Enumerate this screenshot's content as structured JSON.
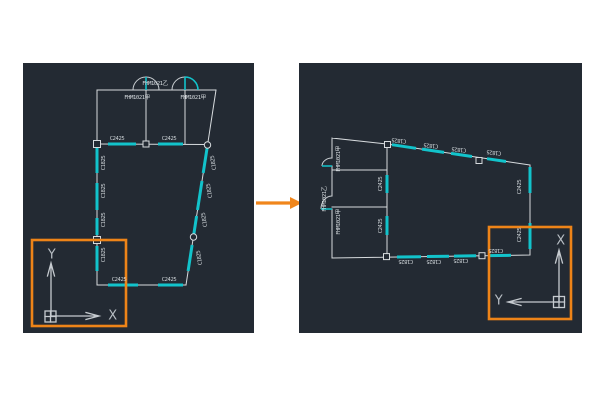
{
  "colors": {
    "viewport_background": "#232A33",
    "wall_line": "#D7DBDE",
    "window_cyan": "#12C3CB",
    "highlight_orange": "#EE8418",
    "arrow_orange": "#F0861C",
    "label_text": "#CDD3D7",
    "ucs_text": "#B7BDC3"
  },
  "panels": [
    {
      "id": "labels-left",
      "name": "viewport-before",
      "labels": [
        {
          "text": "FHM1021乙",
          "x": 132,
          "y": 20,
          "rot": 0,
          "kind": "door"
        },
        {
          "text": "FHM1021甲",
          "x": 114,
          "y": 34,
          "rot": 0,
          "kind": "door"
        },
        {
          "text": "FHM1021甲",
          "x": 170,
          "y": 34,
          "rot": 0,
          "kind": "door"
        },
        {
          "text": "C2425",
          "x": 94,
          "y": 75,
          "rot": 0,
          "kind": "window"
        },
        {
          "text": "C2425",
          "x": 146,
          "y": 75,
          "rot": 0,
          "kind": "window"
        },
        {
          "text": "C2425",
          "x": 96,
          "y": 216,
          "rot": 0,
          "kind": "window"
        },
        {
          "text": "C2425",
          "x": 146,
          "y": 216,
          "rot": 0,
          "kind": "window"
        },
        {
          "text": "C1825",
          "x": 80,
          "y": 100,
          "rot": -90,
          "kind": "window"
        },
        {
          "text": "C1825",
          "x": 80,
          "y": 128,
          "rot": -90,
          "kind": "window"
        },
        {
          "text": "C1825",
          "x": 80,
          "y": 157,
          "rot": -90,
          "kind": "window"
        },
        {
          "text": "C1825",
          "x": 80,
          "y": 192,
          "rot": -90,
          "kind": "window"
        },
        {
          "text": "C1825",
          "x": 190,
          "y": 100,
          "rot": -99,
          "kind": "window"
        },
        {
          "text": "C1825",
          "x": 186,
          "y": 128,
          "rot": -99,
          "kind": "window"
        },
        {
          "text": "C1825",
          "x": 181,
          "y": 157,
          "rot": -99,
          "kind": "window"
        },
        {
          "text": "C1825",
          "x": 176,
          "y": 195,
          "rot": -99,
          "kind": "window"
        },
        {
          "text": "Y",
          "x": 29,
          "y": 191,
          "rot": 0,
          "kind": "ucs"
        },
        {
          "text": "X",
          "x": 90,
          "y": 252,
          "rot": 0,
          "kind": "ucs"
        }
      ]
    },
    {
      "id": "labels-right",
      "name": "viewport-after",
      "labels": [
        {
          "text": "FHM1021甲",
          "x": 39,
          "y": 96,
          "rot": -90,
          "kind": "door"
        },
        {
          "text": "FHM1021乙",
          "x": 25,
          "y": 136,
          "rot": -90,
          "kind": "door"
        },
        {
          "text": "FHM1021甲",
          "x": 39,
          "y": 159,
          "rot": -90,
          "kind": "door"
        },
        {
          "text": "C1825",
          "x": 100,
          "y": 78,
          "rot": 187,
          "kind": "window"
        },
        {
          "text": "C1825",
          "x": 132,
          "y": 83,
          "rot": 187,
          "kind": "window"
        },
        {
          "text": "C1825",
          "x": 160,
          "y": 87,
          "rot": 187,
          "kind": "window"
        },
        {
          "text": "C1825",
          "x": 195,
          "y": 90,
          "rot": 187,
          "kind": "window"
        },
        {
          "text": "C1825",
          "x": 107,
          "y": 199,
          "rot": 180,
          "kind": "window"
        },
        {
          "text": "C1825",
          "x": 135,
          "y": 199,
          "rot": 180,
          "kind": "window"
        },
        {
          "text": "C1825",
          "x": 162,
          "y": 198,
          "rot": 180,
          "kind": "window"
        },
        {
          "text": "C1825",
          "x": 197,
          "y": 188,
          "rot": 180,
          "kind": "window"
        },
        {
          "text": "C2425",
          "x": 220,
          "y": 124,
          "rot": -90,
          "kind": "window"
        },
        {
          "text": "C2425",
          "x": 220,
          "y": 172,
          "rot": -90,
          "kind": "window"
        },
        {
          "text": "C2425",
          "x": 81,
          "y": 121,
          "rot": -90,
          "kind": "window"
        },
        {
          "text": "C2425",
          "x": 81,
          "y": 163,
          "rot": -90,
          "kind": "window"
        },
        {
          "text": "X",
          "x": 262,
          "y": 177,
          "rot": 0,
          "kind": "ucs"
        },
        {
          "text": "Y",
          "x": 200,
          "y": 237,
          "rot": 0,
          "kind": "ucs"
        }
      ]
    }
  ]
}
